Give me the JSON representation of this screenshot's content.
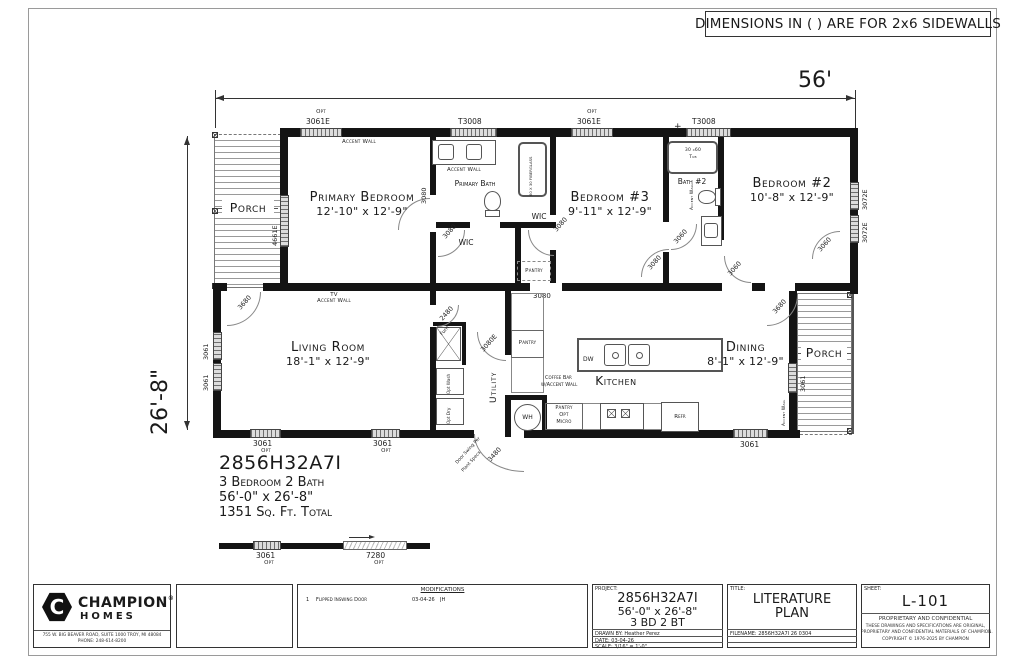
{
  "banner": {
    "text": "DIMENSIONS IN ( ) ARE FOR 2x6 SIDEWALLS"
  },
  "dims": {
    "width": "56'",
    "depth": "26'-8\""
  },
  "rooms": {
    "porch": "Porch",
    "primary_bedroom": {
      "name": "Primary Bedroom",
      "size": "12'-10\" x 12'-9\""
    },
    "primary_bath": "Primary Bath",
    "wic": "WIC",
    "pantry": "Pantry",
    "bedroom3": {
      "name": "Bedroom #3",
      "size": "9'-11\" x 12'-9\""
    },
    "bath2": "Bath #2",
    "bedroom2": {
      "name": "Bedroom #2",
      "size": "10'-8\" x 12'-9\""
    },
    "living": {
      "name": "Living Room",
      "size": "18'-1\" x 12'-9\""
    },
    "utility": "Utility",
    "kitchen": "Kitchen",
    "dining": {
      "name": "Dining",
      "size": "8'-1\" x 12'-9\""
    }
  },
  "notes": {
    "accent_wall": "Accent Wall",
    "tv": "TV",
    "coffee_bar_1": "Coffee Bar",
    "coffee_bar_2": "w/Accent Wall",
    "opt": "Opt",
    "micro": "Micro",
    "door_swing_1": "Door Swing Per",
    "door_swing_2": "Plant Specs",
    "opt_wash": "Opt Wash",
    "opt_dry": "Opt Dry",
    "furn": "Furn",
    "wh": "WH",
    "dw": "DW",
    "refr": "Refr",
    "tub_3060_1": "30 x60",
    "tub_3060_2": "Tub",
    "tub_fiberglass": "60 X 30 FIBERGLASS",
    "plus": "+"
  },
  "windows": {
    "w3061e": "3061E",
    "w3061": "3061",
    "t3008": "T3008",
    "w3072e": "3072E",
    "w4661e": "4661E"
  },
  "doors": {
    "d3080": "3080",
    "d3060": "3060",
    "d3680": "3680",
    "d2480": "2480",
    "d3480": "3480",
    "d3080e": "3080E",
    "d7280": "7280"
  },
  "summary": {
    "model": "2856H32A7I",
    "config": "3 Bedroom 2 Bath",
    "size": "56'-0\" x 26'-8\"",
    "area": "1351 Sq. Ft. Total"
  },
  "titleblock": {
    "company": {
      "name": "CHAMPION",
      "reg": "®",
      "sub": "HOMES",
      "address": "755 W. BIG BEAVER ROAD, SUITE 1000  TROY, MI  48084",
      "phone": "PHONE: 248-614-8200"
    },
    "modifications": {
      "header": "MODIFICATIONS",
      "row_num": "1",
      "row_desc": "Flipped Inswing Door",
      "row_date": "03-04-26",
      "row_by": "JH"
    },
    "project": {
      "label": "PROJECT:",
      "model": "2856H32A7I",
      "size": "56'-0\" x 26'-8\"",
      "config": "3 BD 2 BT"
    },
    "drawn_by": "DRAWN BY: Heather Perez",
    "date": "DATE: 03-04-26",
    "scale": "SCALE: 3/16\" = 1'-0\"",
    "title": {
      "label": "TITLE:",
      "line1": "LITERATURE",
      "line2": "PLAN"
    },
    "filename": "FILENAME: 2856H32A7I 26 0304",
    "sheet": {
      "label": "SHEET:",
      "value": "L-101"
    },
    "legal": {
      "header": "PROPRIETARY AND CONFIDENTIAL",
      "line1": "THESE DRAWINGS AND SPECIFICATIONS ARE ORIGINAL,",
      "line2": "PROPRIETARY AND CONFIDENTIAL MATERIALS OF CHAMPION.",
      "line3": "COPYRIGHT © 1976-2025 BY CHAMPION"
    }
  }
}
